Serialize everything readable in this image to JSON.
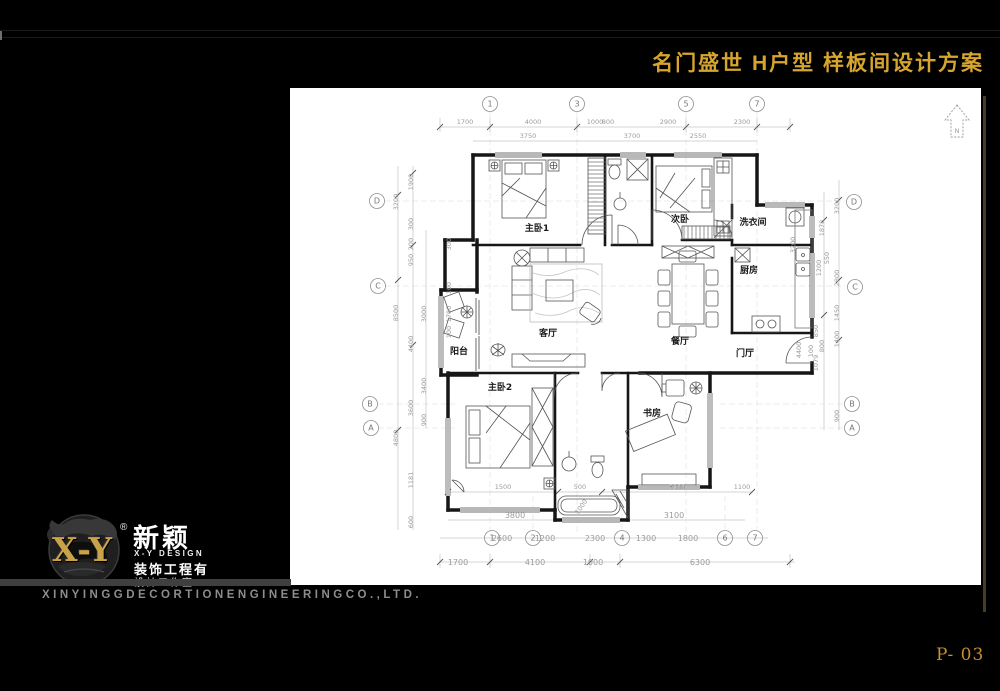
{
  "title": "名门盛世 H户型 样板间设计方案",
  "page_number": "P- 03",
  "footer": {
    "company": "XINYINGGDECORTIONENGINEERINGCO.,LTD."
  },
  "logo": {
    "monogram": "X-Y",
    "registered": "®",
    "name_cn": "新颖",
    "name_en": "X-Y DESIGN",
    "line1": "装饰工程有",
    "line2": "設計工作室"
  },
  "colors": {
    "background": "#000000",
    "title_gold": "#D7A52F",
    "logo_gold": "#C9A24A",
    "page_gold": "#C78F2D",
    "paper_white": "#ffffff",
    "footer_gray": "#8d8d8d"
  },
  "plan": {
    "north_label": "N",
    "rooms": {
      "master1": "主卧1",
      "second_bedroom": "次卧",
      "laundry": "洗衣间",
      "kitchen": "厨房",
      "living": "客厅",
      "dining": "餐厅",
      "balcony": "阳台",
      "foyer": "门厅",
      "master2": "主卧2",
      "study": "书房"
    },
    "grid_top": [
      "1",
      "3",
      "5",
      "7"
    ],
    "grid_bottom": [
      "1",
      "2",
      "4",
      "6",
      "7"
    ],
    "grid_left": [
      "D",
      "C",
      "B",
      "A"
    ],
    "grid_right": [
      "D",
      "C",
      "B",
      "A"
    ],
    "top1": [
      "1700",
      "4000",
      "1000",
      "800",
      "2900",
      "2300"
    ],
    "top2": [
      "3750",
      "3700",
      "2550"
    ],
    "bot1": [
      "1500",
      "500",
      "3900",
      "1100"
    ],
    "bot2": [
      "3800",
      "3100"
    ],
    "bot3": [
      "2600",
      "1200",
      "2300",
      "1300",
      "1800"
    ],
    "bot4": [
      "1700",
      "4100",
      "1000",
      "6300"
    ],
    "left1": [
      "3200",
      "8500",
      "4800"
    ],
    "left2": [
      "1900",
      "300",
      "200",
      "950",
      "4400",
      "3600",
      "1181",
      "600"
    ],
    "left3": [
      "3000",
      "3400",
      "900"
    ],
    "left_inner": [
      "300",
      "100",
      "1700",
      "100"
    ],
    "right1": [
      "3200",
      "2800",
      "1450",
      "1400",
      "900"
    ],
    "right2": [
      "1878",
      "550",
      "1200",
      "850",
      "800",
      "1079",
      "100"
    ],
    "right_inner": [
      "3200",
      "4400"
    ],
    "diag_dim": "1000"
  }
}
